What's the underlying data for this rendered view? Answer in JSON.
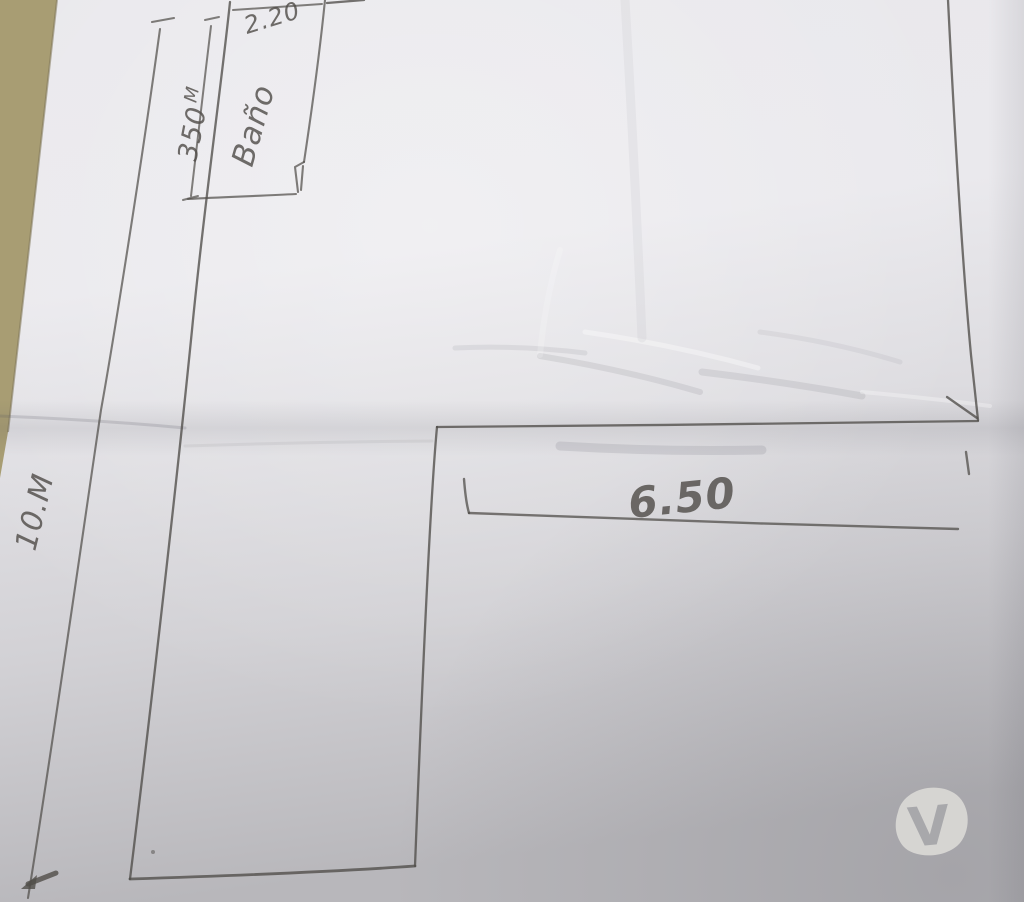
{
  "sketch": {
    "room_label": "Baño",
    "dimensions": {
      "bathroom_width": "2.20",
      "bathroom_length_value": "350",
      "bathroom_length_unit": "M",
      "left_side_length": "10.M",
      "right_wing_width": "6.50"
    },
    "colors": {
      "pencil": "#504d49",
      "paper_base": "#e7e6ea",
      "table_surface": "#a89d73",
      "watermark_blob": "#d8d7d4",
      "watermark_letter": "#a8a8ab"
    }
  },
  "watermark": {
    "letter": "V"
  }
}
